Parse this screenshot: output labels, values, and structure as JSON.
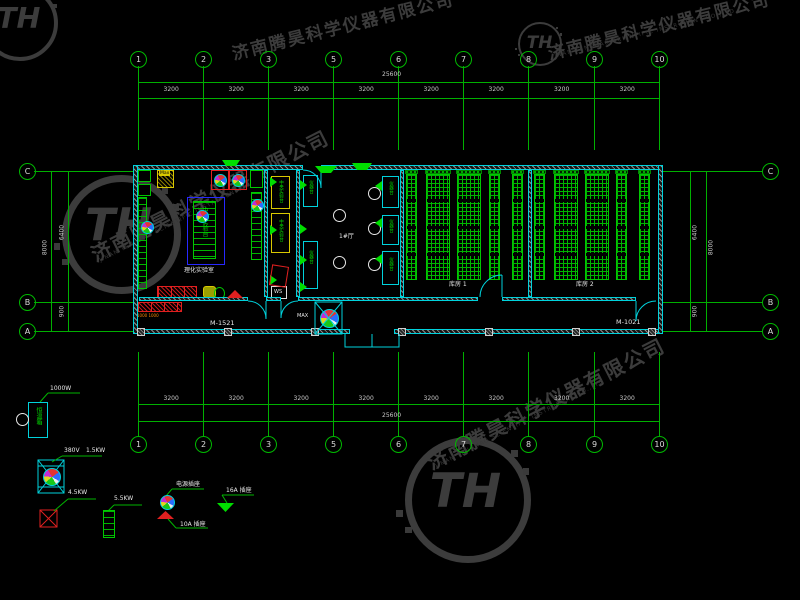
{
  "watermark": {
    "company_cn": "济南腾昊科学仪器有限公司",
    "company_en": "JINAN TENGHAO SCIENTIFIC INSTRUMENT CO.,LTD",
    "monogram": "TH"
  },
  "grid": {
    "top_columns": [
      "1",
      "2",
      "3",
      "5",
      "6",
      "7",
      "8",
      "9",
      "10"
    ],
    "bottom_columns": [
      "1",
      "2",
      "3",
      "5",
      "6",
      "7",
      "8",
      "9",
      "10"
    ],
    "left_rows": [
      "C",
      "B",
      "A"
    ],
    "right_rows": [
      "C",
      "B",
      "A"
    ],
    "segment_dim": "3200",
    "total_dim": "25600",
    "vertical_total": "8000",
    "vertical_upper": "6400",
    "vertical_lower": "900"
  },
  "plan": {
    "door_tags": {
      "left": "M-1521",
      "right": "M-1021"
    },
    "fan_label": "MAX",
    "under_counter_dims": "1000 1000",
    "rooms": {
      "lab": {
        "name": "理化实验室",
        "bench": "中央实验台"
      },
      "prep": {
        "bench": "中央实验台",
        "ws": "WS",
        "max_cabinet": "Max"
      },
      "hall": {
        "name": "1#厅",
        "bench": "仪器台"
      },
      "store1": {
        "name": "库房 1"
      },
      "store2": {
        "name": "库房 2"
      }
    }
  },
  "legend": {
    "items": [
      {
        "label": "1000W",
        "box_text": "恒温箱"
      },
      {
        "labels": [
          "380V",
          "1.5KW"
        ]
      },
      {
        "label": "4.5KW"
      },
      {
        "label": "5.5KW"
      },
      {
        "label": "电源插座"
      },
      {
        "label": "10A 插座"
      },
      {
        "label": "16A 插座"
      }
    ]
  }
}
